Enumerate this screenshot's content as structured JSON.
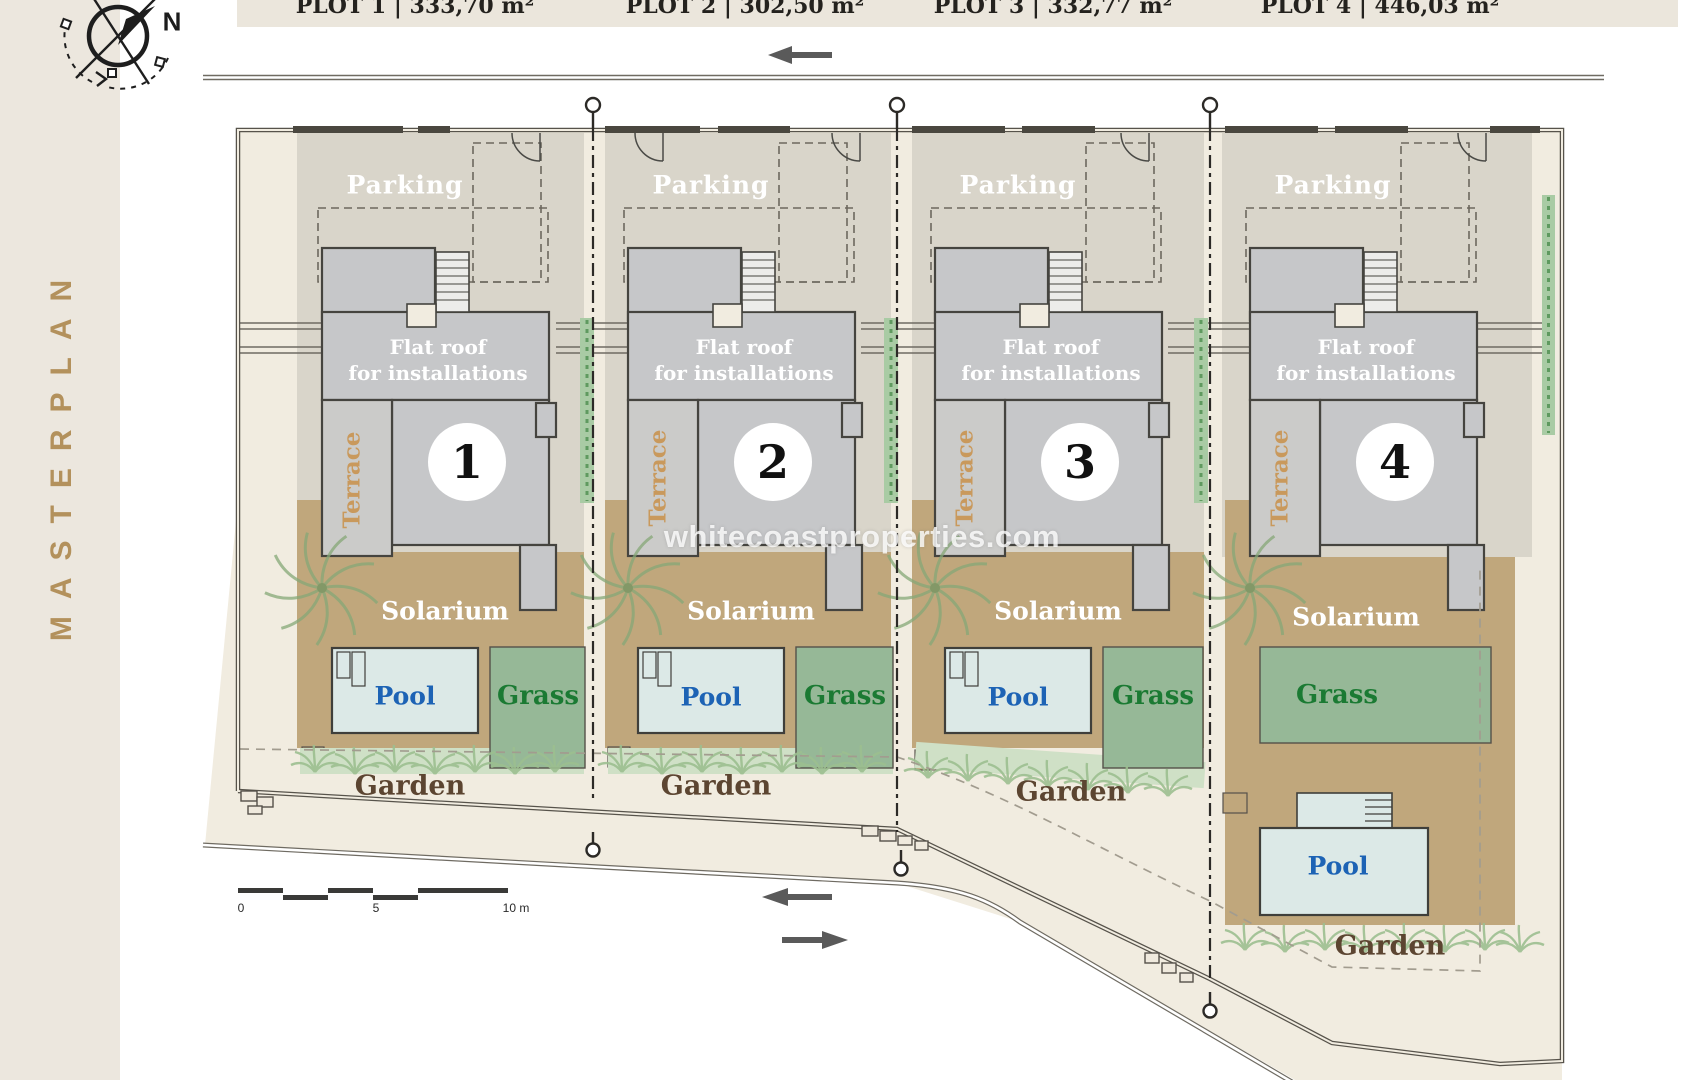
{
  "sidebar": {
    "title": "MASTERPLAN"
  },
  "compass": {
    "north_label": "N"
  },
  "plots": [
    {
      "id": "1",
      "header": "PLOT 1 | 333,70 m²",
      "labels": {
        "parking": "Parking",
        "flat_roof_line1": "Flat roof",
        "flat_roof_line2": "for installations",
        "terrace": "Terrace",
        "number": "1",
        "solarium": "Solarium",
        "pool": "Pool",
        "grass": "Grass",
        "garden": "Garden"
      }
    },
    {
      "id": "2",
      "header": "PLOT 2 | 302,50 m²",
      "labels": {
        "parking": "Parking",
        "flat_roof_line1": "Flat roof",
        "flat_roof_line2": "for installations",
        "terrace": "Terrace",
        "number": "2",
        "solarium": "Solarium",
        "pool": "Pool",
        "grass": "Grass",
        "garden": "Garden"
      }
    },
    {
      "id": "3",
      "header": "PLOT 3 | 332,77 m²",
      "labels": {
        "parking": "Parking",
        "flat_roof_line1": "Flat roof",
        "flat_roof_line2": "for installations",
        "terrace": "Terrace",
        "number": "3",
        "solarium": "Solarium",
        "pool": "Pool",
        "grass": "Grass",
        "garden": "Garden"
      }
    },
    {
      "id": "4",
      "header": "PLOT 4 | 446,03 m²",
      "labels": {
        "parking": "Parking",
        "flat_roof_line1": "Flat roof",
        "flat_roof_line2": "for installations",
        "terrace": "Terrace",
        "number": "4",
        "solarium": "Solarium",
        "pool": "Pool",
        "grass": "Grass",
        "garden": "Garden"
      }
    }
  ],
  "watermark": {
    "text": "whitecoastproperties.com"
  },
  "scale_bar": {
    "tick_0": "0",
    "tick_5": "5",
    "tick_10": "10 m"
  },
  "colors": {
    "accent_gold": "#b3915c",
    "pool_text": "#1d63b5",
    "grass_text": "#1b7a33",
    "garden_text": "#5c4531",
    "terrace_text": "#c9995c",
    "solarium_fill": "#c0a77c",
    "grass_fill": "#96b897",
    "pool_fill": "#dce9e7",
    "roof_fill": "#c6c7c9",
    "ground_fill": "#d9d5ca",
    "site_fill": "#f1ece0"
  }
}
